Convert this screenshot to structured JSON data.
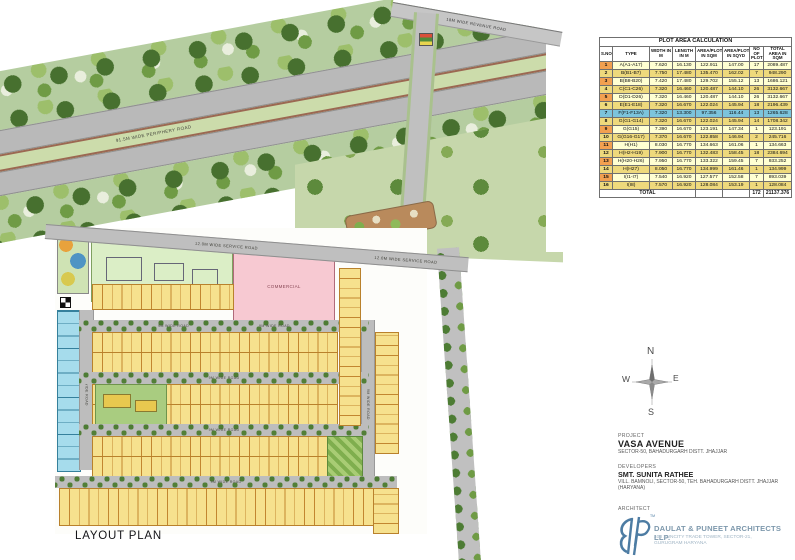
{
  "table": {
    "title": "PLOT AREA CALCULATION",
    "columns": [
      "S.NO",
      "TYPE",
      "WIDTH IN M",
      "LENGTH IN M",
      "AREA/PLOT IN SQM",
      "AREA/PLOT IN SQYD",
      "NO OF PLOTS",
      "TOTAL AREA IN SQM"
    ],
    "rows": [
      [
        "1",
        "A(A1-A17)",
        "7.620",
        "16.130",
        "122.911",
        "147.00",
        "17",
        "2089.487"
      ],
      [
        "2",
        "B(B1-B7)",
        "7.750",
        "17.480",
        "135.470",
        "162.02",
        "7",
        "948.290"
      ],
      [
        "3",
        "B(B8-B20)",
        "7.420",
        "17.480",
        "129.702",
        "155.12",
        "13",
        "1686.121"
      ],
      [
        "4",
        "C(C1-C26)",
        "7.320",
        "16.460",
        "120.487",
        "144.10",
        "26",
        "3132.667"
      ],
      [
        "5",
        "D(D1-D26)",
        "7.320",
        "16.460",
        "120.487",
        "144.10",
        "26",
        "3132.667"
      ],
      [
        "6",
        "E(E1-E18)",
        "7.320",
        "16.670",
        "122.024",
        "145.94",
        "18",
        "2196.439"
      ],
      [
        "7",
        "F(F1-F13A)",
        "7.320",
        "13.300",
        "97.356",
        "116.44",
        "13",
        "1265.628"
      ],
      [
        "8",
        "G(G1-G14)",
        "7.320",
        "16.670",
        "122.024",
        "145.94",
        "14",
        "1708.342"
      ],
      [
        "9",
        "G(G15)",
        "7.390",
        "16.670",
        "123.191",
        "147.34",
        "1",
        "123.191"
      ],
      [
        "10",
        "G(G16-G17)",
        "7.370",
        "16.670",
        "122.858",
        "146.94",
        "2",
        "245.716"
      ],
      [
        "11",
        "H(H1)",
        "8.030",
        "16.770",
        "134.663",
        "161.06",
        "1",
        "134.663"
      ],
      [
        "12",
        "H(H2-H19)",
        "7.900",
        "16.770",
        "132.483",
        "158.45",
        "18",
        "2384.694"
      ],
      [
        "13",
        "H(H20-H26)",
        "7.950",
        "16.770",
        "133.322",
        "159.45",
        "7",
        "933.252"
      ],
      [
        "14",
        "H(H27)",
        "8.050",
        "16.770",
        "134.999",
        "161.46",
        "1",
        "134.999"
      ],
      [
        "15",
        "I(I1-I7)",
        "7.540",
        "16.920",
        "127.577",
        "152.58",
        "7",
        "893.039"
      ],
      [
        "16",
        "I(I8)",
        "7.570",
        "16.920",
        "128.084",
        "153.19",
        "1",
        "128.084"
      ]
    ],
    "highlighted_row": 7,
    "total": {
      "label": "TOTAL",
      "plots": "172",
      "area_sqm": "21137.376"
    }
  },
  "plan": {
    "labels": {
      "periphery_road": "91.5M WIDE PERIPHERY ROAD",
      "service_road": "12.0M WIDE SERVICE ROAD",
      "revenue_road": "18M WIDE REVENUE ROAD",
      "internal_road": "9M WIDE ROAD",
      "community_space": "COMMUNITY SPACE",
      "commercial": "COMMERCIAL"
    },
    "plot_dimension_examples": [
      "7.620X16.130",
      "7.750X17.480",
      "7.320X16.460",
      "7.320X16.670",
      "7.320X13.300"
    ]
  },
  "compass": {
    "north": "N",
    "south": "S",
    "east": "E",
    "west": "W"
  },
  "info": {
    "project": {
      "label": "PROJECT",
      "name": "VASA AVENUE",
      "address": "SECTOR-50, BAHADURGARH DISTT. JHAJJAR"
    },
    "developers": {
      "label": "DEVELOPERS",
      "name": "SMT. SUNITA RATHEE",
      "address_line1": "VILL. BAMNOLI, SECTOR-50, TEH. BAHADURGARH DISTT. JHAJJAR",
      "address_line2": "(HARYANA)"
    },
    "architect": {
      "label": "ARCHITECT",
      "firm": "DAULAT & PUNEET ARCHITECTS LLP.",
      "address_line1": "408 SUNCITY TRADE TOWER, SECTOR-21,",
      "address_line2": "GURUGRAM HARYANA",
      "trademark": "TM"
    }
  },
  "footer": {
    "title": "LAYOUT PLAN"
  },
  "colors": {
    "plot_yellow": "#f6e18e",
    "plot_outline": "#b9812c",
    "plot_blue": "#a6dcec",
    "commercial_pink": "#f7c9d2",
    "community_green": "#dbeec6",
    "road_gray": "#bdbdbd",
    "belt_green": "#b5cda0",
    "tree_dark": "#47702f",
    "median_brown": "#9b6852",
    "table_sno_orange": "#f2a050",
    "table_row_gold": "#eed97c",
    "table_row_pale": "#ffffd2",
    "table_highlight": "#7cc4dc",
    "logo_blue": "#4d7ca3"
  }
}
